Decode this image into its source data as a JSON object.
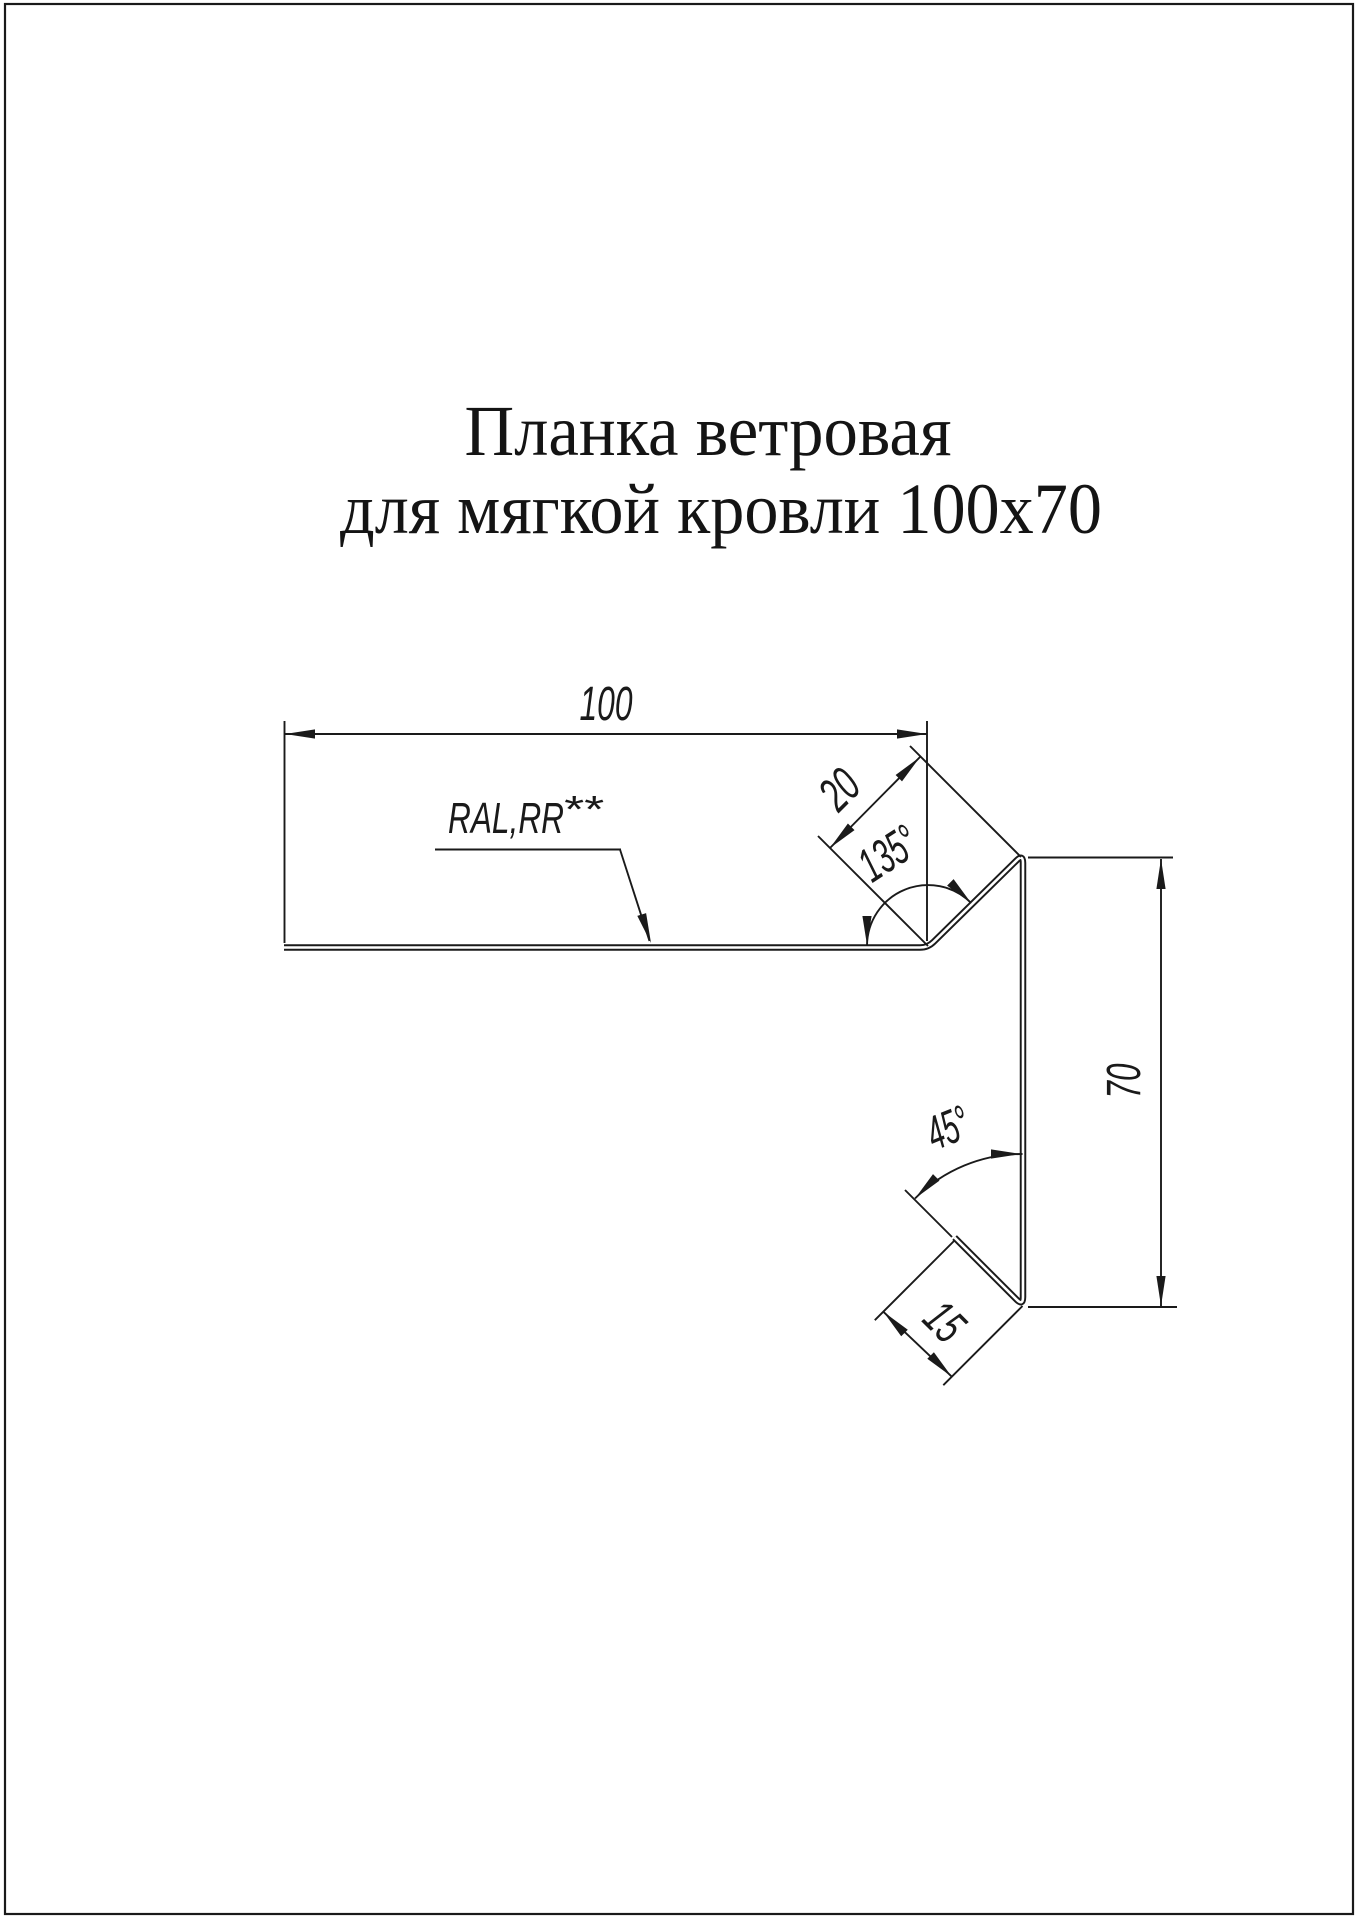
{
  "title": {
    "line1": "Планка ветровая",
    "line2": "для мягкой кровли 100х70"
  },
  "dimensions": {
    "top_width": "100",
    "top_flange": "20",
    "top_angle": "135°",
    "side_height": "70",
    "bottom_angle": "45°",
    "bottom_flange": "15"
  },
  "labels": {
    "coating": "RAL,RR",
    "coating_mark": "**"
  },
  "colors": {
    "ink": "#1a1a1a",
    "paper": "#ffffff"
  }
}
